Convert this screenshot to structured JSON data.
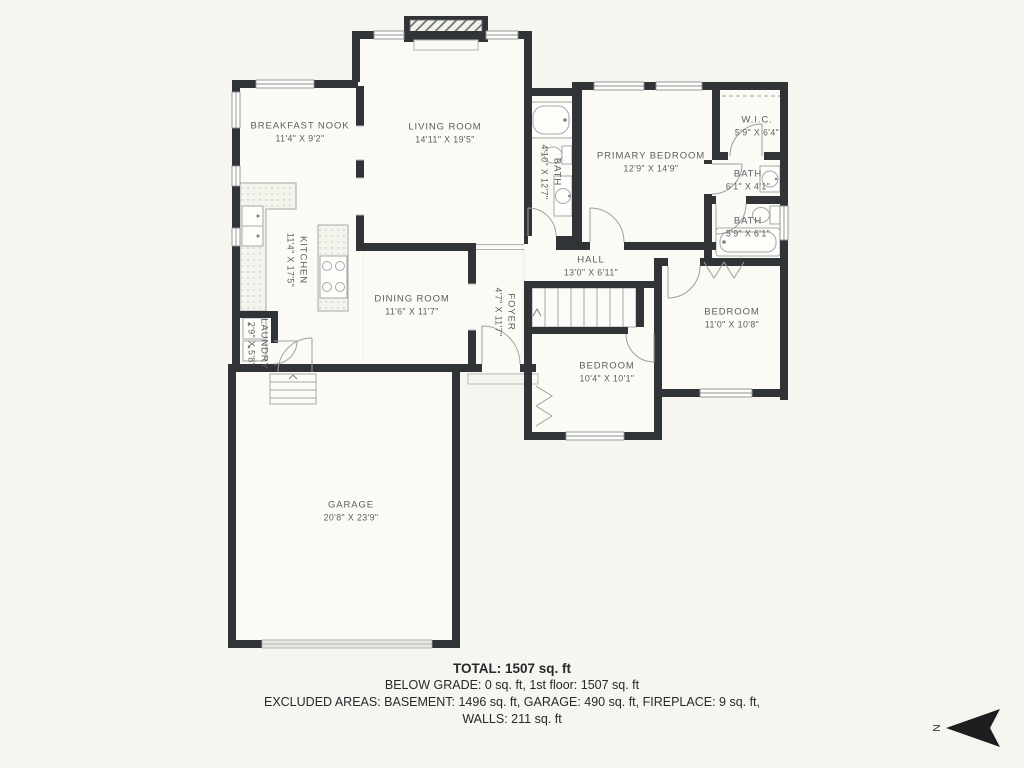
{
  "plan": {
    "rooms": [
      {
        "id": "breakfast-nook",
        "name": "BREAKFAST NOOK",
        "dims": "11'4\" X 9'2\""
      },
      {
        "id": "living-room",
        "name": "LIVING ROOM",
        "dims": "14'11\" X 19'5\""
      },
      {
        "id": "hall-bath",
        "name": "BATH",
        "dims": "4'10\" X 12'7\""
      },
      {
        "id": "primary-bedroom",
        "name": "PRIMARY BEDROOM",
        "dims": "12'9\" X 14'9\""
      },
      {
        "id": "walk-in-closet",
        "name": "W.I.C.",
        "dims": "5'9\" X 6'4\""
      },
      {
        "id": "ensuite-bath",
        "name": "BATH",
        "dims": "6'1\" X 4'1\""
      },
      {
        "id": "second-bath",
        "name": "BATH",
        "dims": "5'9\" X 6'1\""
      },
      {
        "id": "kitchen",
        "name": "KITCHEN",
        "dims": "11'4\" X 17'5\""
      },
      {
        "id": "dining-room",
        "name": "DINING ROOM",
        "dims": "11'6\" X 11'7\""
      },
      {
        "id": "hall",
        "name": "HALL",
        "dims": "13'0\" X 6'11\""
      },
      {
        "id": "foyer",
        "name": "FOYER",
        "dims": "4'7\" X 11'7\""
      },
      {
        "id": "laundry",
        "name": "LAUNDRY",
        "dims": "2'9\" X 5'8\""
      },
      {
        "id": "bedroom-1",
        "name": "BEDROOM",
        "dims": "10'4\" X 10'1\""
      },
      {
        "id": "bedroom-2",
        "name": "BEDROOM",
        "dims": "11'0\" X 10'8\""
      },
      {
        "id": "garage",
        "name": "GARAGE",
        "dims": "20'8\" X 23'9\""
      }
    ],
    "compass": {
      "label": "N"
    }
  },
  "footer": {
    "total": "TOTAL: 1507 sq. ft",
    "below_grade": "BELOW GRADE: 0 sq. ft, 1st floor: 1507 sq. ft",
    "excluded": "EXCLUDED AREAS: BASEMENT: 1496 sq. ft, GARAGE: 490 sq. ft, FIREPLACE: 9 sq. ft,",
    "walls": "WALLS: 211 sq. ft"
  },
  "colors": {
    "background": "#f6f5ef",
    "room_fill": "#fbfaf4",
    "wall": "#303437",
    "fixture_line": "#a5a9ac",
    "label_text": "#5a5f63",
    "footer_text": "#26292c"
  }
}
